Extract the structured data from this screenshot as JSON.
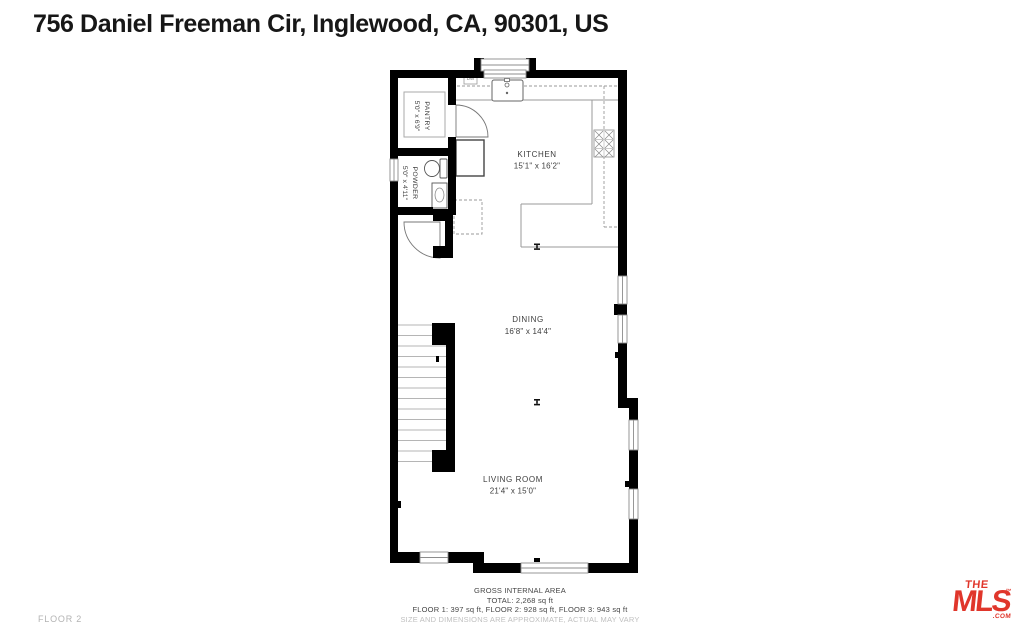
{
  "page": {
    "title": "756 Daniel Freeman Cir, Inglewood, CA, 90301, US",
    "floor_label": "FLOOR 2"
  },
  "rooms": {
    "kitchen": {
      "name": "KITCHEN",
      "dims": "15'1\" x 16'2\""
    },
    "dining": {
      "name": "DINING",
      "dims": "16'8\" x 14'4\""
    },
    "living_room": {
      "name": "LIVING ROOM",
      "dims": "21'4\" x 15'0\""
    },
    "pantry": {
      "name": "PANTRY",
      "dims": "5'0\" x 6'9\""
    },
    "powder": {
      "name": "POWDER",
      "dims": "5'0\" x 4'11\""
    }
  },
  "labels": {
    "dishwasher": "DW"
  },
  "footer": {
    "gross_area": "GROSS INTERNAL AREA",
    "total": "TOTAL: 2,268 sq ft",
    "floor_breakdown": "FLOOR 1: 397 sq ft, FLOOR 2: 928 sq ft, FLOOR 3: 943 sq ft",
    "disclaimer": "SIZE AND DIMENSIONS ARE APPROXIMATE, ACTUAL MAY VARY"
  },
  "logo": {
    "the": "THE",
    "mls": "MLS",
    "tm": "™",
    "com": ".COM"
  },
  "colors": {
    "wall": "#000000",
    "accent_red": "#e0362b",
    "thin_line": "#9a9a9a",
    "muted_text": "#b3b3b3",
    "label_text": "#3d3d3d"
  }
}
